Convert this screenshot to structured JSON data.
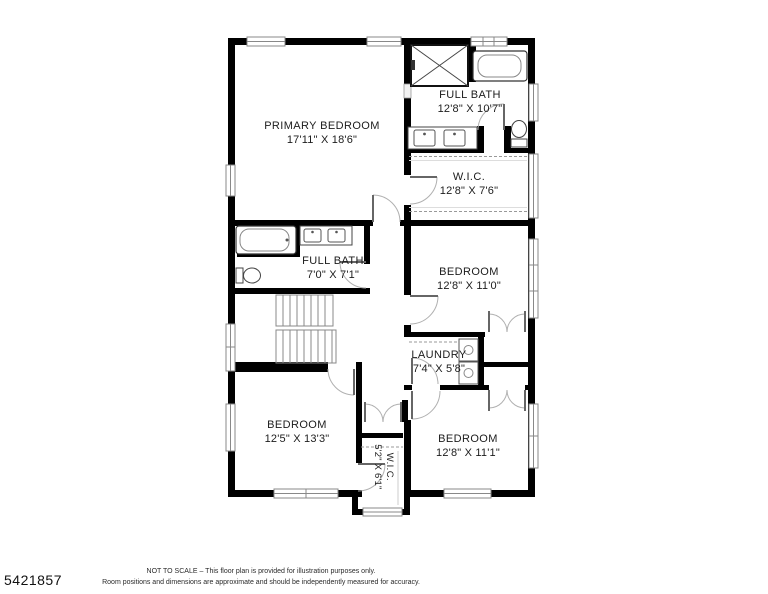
{
  "mls_id": "5421857",
  "disclaimer": {
    "line1": "NOT TO SCALE – This floor plan is provided for illustration purposes only.",
    "line2": "Room positions and dimensions are approximate and should be independently measured for accuracy."
  },
  "rooms": [
    {
      "id": "primary-bedroom",
      "name": "PRIMARY BEDROOM",
      "dims": "17'11\" X 18'6\""
    },
    {
      "id": "full-bath-1",
      "name": "FULL BATH",
      "dims": "12'8\" X 10'7\""
    },
    {
      "id": "wic-1",
      "name": "W.I.C.",
      "dims": "12'8\" X 7'6\""
    },
    {
      "id": "full-bath-2",
      "name": "FULL BATH",
      "dims": "7'0\" X 7'1\""
    },
    {
      "id": "bedroom-middle",
      "name": "BEDROOM",
      "dims": "12'8\" X 11'0\""
    },
    {
      "id": "laundry",
      "name": "LAUNDRY",
      "dims": "7'4\" X 5'8\""
    },
    {
      "id": "bedroom-bottom-left",
      "name": "BEDROOM",
      "dims": "12'5\" X 13'3\""
    },
    {
      "id": "bedroom-bottom-right",
      "name": "BEDROOM",
      "dims": "12'8\" X 11'1\""
    },
    {
      "id": "wic-2",
      "name": "W.I.C.",
      "dims": "5'2\" X 6'1\""
    }
  ],
  "colors": {
    "wall": "#000000",
    "door_arc": "#b0b0b0",
    "fixture": "#555555",
    "window": "#888888"
  }
}
